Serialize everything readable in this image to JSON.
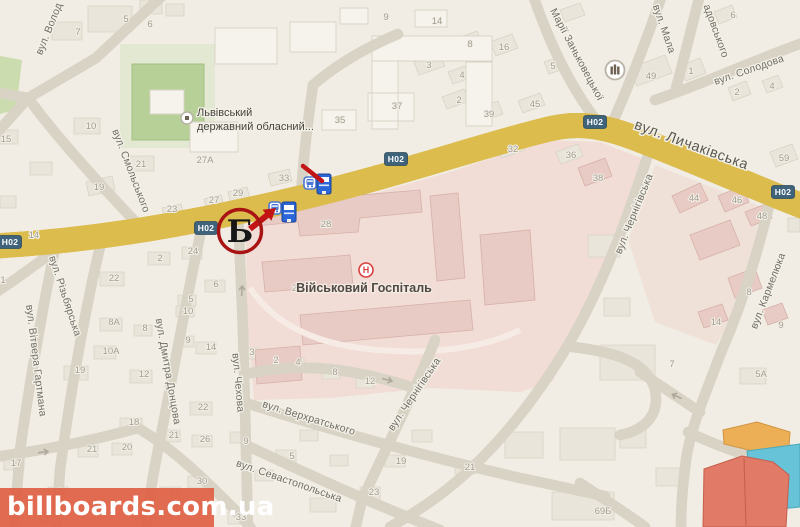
{
  "map": {
    "watermark": {
      "text": "billboards.com.ua",
      "band_color": "#df5f43",
      "text_color": "#ffffff"
    },
    "marker": {
      "letter": "Б",
      "ring_color": "#a81313",
      "arrow_color": "#c21414"
    },
    "route_shield": {
      "text": "H02",
      "bg_color": "#3f637a",
      "text_color": "#ffffff"
    },
    "shields": [
      {
        "x": 10,
        "y": 242
      },
      {
        "x": 206,
        "y": 228
      },
      {
        "x": 396,
        "y": 159
      },
      {
        "x": 595,
        "y": 122
      },
      {
        "x": 783,
        "y": 192
      }
    ],
    "main_road_color": "#f7df4f",
    "streets": [
      {
        "t": "вул. Волод",
        "x": 52,
        "y": 30,
        "r": -68
      },
      {
        "t": "вул. Смольського",
        "x": 128,
        "y": 172,
        "r": 69
      },
      {
        "t": "вул. Вітвера Гартмана",
        "x": 33,
        "y": 361,
        "r": 83
      },
      {
        "t": "вул. Різьбярська",
        "x": 62,
        "y": 297,
        "r": 72
      },
      {
        "t": "вул. Дмитра Донцова",
        "x": 165,
        "y": 372,
        "r": 80
      },
      {
        "t": "вул. Чехова",
        "x": 235,
        "y": 383,
        "r": 85
      },
      {
        "t": "вул. Верхратського",
        "x": 308,
        "y": 421,
        "r": 17
      },
      {
        "t": "вул. Севастопольська",
        "x": 288,
        "y": 484,
        "r": 19
      },
      {
        "t": "вул. Чернігівська",
        "x": 637,
        "y": 215,
        "r": -68
      },
      {
        "t": "вул. Чернігівська",
        "x": 417,
        "y": 396,
        "r": -56
      },
      {
        "t": "вул. Кармелюка",
        "x": 771,
        "y": 292,
        "r": -69
      },
      {
        "t": "Марії Заньковецької",
        "x": 574,
        "y": 56,
        "r": 62
      },
      {
        "t": "вул. Мала",
        "x": 661,
        "y": 30,
        "r": 71
      },
      {
        "t": "адовського",
        "x": 713,
        "y": 32,
        "r": 70
      },
      {
        "t": "вул. Солодова",
        "x": 750,
        "y": 73,
        "r": -19
      },
      {
        "t": "вул. Личаківська",
        "x": 690,
        "y": 149,
        "r": 20,
        "cls": "major"
      }
    ],
    "house_numbers": [
      [
        "5",
        126,
        22
      ],
      [
        "6",
        150,
        27
      ],
      [
        "7",
        78,
        35
      ],
      [
        "10",
        91,
        129
      ],
      [
        "15",
        6,
        142
      ],
      [
        "21",
        141,
        167
      ],
      [
        "27А",
        205,
        163
      ],
      [
        "9",
        386,
        20
      ],
      [
        "14",
        437,
        24
      ],
      [
        "8",
        470,
        47
      ],
      [
        "16",
        504,
        50
      ],
      [
        "3",
        429,
        68
      ],
      [
        "4",
        462,
        78
      ],
      [
        "2",
        459,
        103
      ],
      [
        "37",
        397,
        109
      ],
      [
        "35",
        340,
        123
      ],
      [
        "39",
        489,
        117
      ],
      [
        "45",
        535,
        107
      ],
      [
        "32",
        513,
        152
      ],
      [
        "33",
        284,
        181
      ],
      [
        "6",
        733,
        18
      ],
      [
        "5",
        553,
        69
      ],
      [
        "49",
        651,
        79
      ],
      [
        "1",
        691,
        74
      ],
      [
        "2",
        737,
        95
      ],
      [
        "4",
        772,
        89
      ],
      [
        "36",
        571,
        158
      ],
      [
        "59",
        784,
        161
      ],
      [
        "19",
        99,
        190
      ],
      [
        "23",
        172,
        212
      ],
      [
        "27",
        214,
        203
      ],
      [
        "29",
        238,
        196
      ],
      [
        "14",
        34,
        238
      ],
      [
        "2",
        160,
        261
      ],
      [
        "24",
        193,
        254
      ],
      [
        "22",
        114,
        281
      ],
      [
        "6",
        216,
        287
      ],
      [
        "5",
        191,
        302
      ],
      [
        "1",
        3,
        283
      ],
      [
        "8А",
        114,
        325
      ],
      [
        "8",
        145,
        331
      ],
      [
        "10",
        188,
        314
      ],
      [
        "9",
        188,
        343
      ],
      [
        "10А",
        111,
        354
      ],
      [
        "26",
        297,
        291
      ],
      [
        "28",
        326,
        227
      ],
      [
        "38",
        598,
        181
      ],
      [
        "44",
        694,
        201
      ],
      [
        "46",
        737,
        203
      ],
      [
        "48",
        762,
        219
      ],
      [
        "8",
        749,
        295
      ],
      [
        "14",
        716,
        325
      ],
      [
        "9",
        781,
        328
      ],
      [
        "19",
        80,
        373
      ],
      [
        "12",
        144,
        377
      ],
      [
        "14",
        211,
        350
      ],
      [
        "3",
        252,
        355
      ],
      [
        "22",
        203,
        410
      ],
      [
        "18",
        134,
        425
      ],
      [
        "21",
        174,
        438
      ],
      [
        "26",
        205,
        442
      ],
      [
        "20",
        127,
        450
      ],
      [
        "21",
        92,
        452
      ],
      [
        "17",
        16,
        466
      ],
      [
        "30",
        202,
        484
      ],
      [
        "29",
        174,
        495
      ],
      [
        "34",
        62,
        495
      ],
      [
        "33",
        241,
        520
      ],
      [
        "9",
        246,
        444
      ],
      [
        "31",
        202,
        507
      ],
      [
        "32",
        49,
        522
      ],
      [
        "2",
        276,
        363
      ],
      [
        "4",
        298,
        365
      ],
      [
        "8",
        335,
        375
      ],
      [
        "12",
        370,
        384
      ],
      [
        "5",
        292,
        459
      ],
      [
        "19",
        401,
        464
      ],
      [
        "21",
        470,
        470
      ],
      [
        "23",
        374,
        495
      ],
      [
        "7",
        672,
        367
      ],
      [
        "5А",
        761,
        377
      ],
      [
        "69Б",
        603,
        514
      ]
    ],
    "pois": {
      "hospital": {
        "label": "Військовий Госпіталь",
        "icon_letter": "Н",
        "icon_x": 366,
        "icon_y": 270,
        "label_x": 364,
        "label_y": 292
      },
      "regional": {
        "lines": [
          "Львівський",
          "державний обласний..."
        ],
        "icon_x": 187,
        "icon_y": 118,
        "text_x": 197,
        "line1_y": 116,
        "line2_y": 130
      },
      "landmark": {
        "icon_x": 615,
        "icon_y": 70
      }
    },
    "transit_stops": [
      {
        "x": 310,
        "y": 183
      },
      {
        "x": 275,
        "y": 208
      }
    ],
    "billboards": [
      {
        "x": 324,
        "y": 184
      },
      {
        "x": 289,
        "y": 212
      }
    ],
    "billboard_blue": "#2b66d9"
  }
}
